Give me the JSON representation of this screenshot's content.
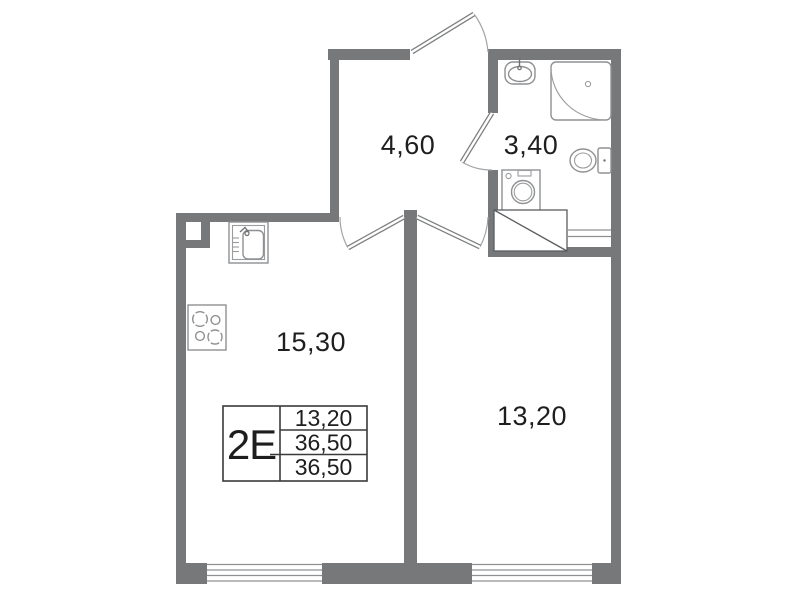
{
  "plan": {
    "rooms": [
      {
        "id": "hallway",
        "area": "4,60"
      },
      {
        "id": "bathroom",
        "area": "3,40"
      },
      {
        "id": "kitchen-living-room",
        "area": "15,30"
      },
      {
        "id": "bedroom",
        "area": "13,20"
      }
    ],
    "legend": {
      "type": "2E",
      "values": [
        "13,20",
        "36,50",
        "36,50"
      ]
    },
    "fixtures": [
      "bathroom-sink-icon",
      "corner-shower-icon",
      "toilet-icon",
      "washing-machine-icon",
      "vent-shaft-icon",
      "kitchen-sink-icon",
      "stove-icon"
    ],
    "window_count": 2,
    "door_count": 4
  },
  "colors": {
    "wall": "#76787a",
    "fixture_outline": "#8e9092",
    "dark_outline": "#3a3a3a",
    "text": "#1e1e1e",
    "background": "#ffffff"
  }
}
